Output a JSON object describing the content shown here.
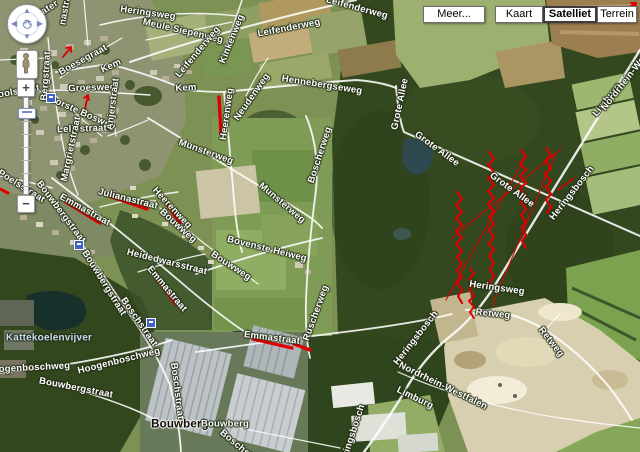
{
  "theme": {
    "red-overlay": "#dd0000",
    "stop-blue": "#3f63c8",
    "selected-border": "#3c3c3c",
    "label-halo": "#222d14"
  },
  "toolbar": {
    "buttons": [
      {
        "label": "Meer...",
        "selected": false
      },
      {
        "label": "Kaart",
        "selected": false
      },
      {
        "label": "Satelliet",
        "selected": true
      },
      {
        "label": "Terrein",
        "selected": false
      }
    ]
  },
  "nav": {
    "zoom_in_label": "+",
    "zoom_out_label": "−",
    "arrows": {
      "up": "▲",
      "down": "▼",
      "left": "◀",
      "right": "▶"
    }
  },
  "map": {
    "labels": [
      {
        "text": "Heringsweg",
        "x": 148,
        "y": 13,
        "rot": 8
      },
      {
        "text": "Meule Siepenweg",
        "x": 183,
        "y": 31,
        "rot": 13
      },
      {
        "text": "Leifenderweg",
        "x": 198,
        "y": 52,
        "rot": -50
      },
      {
        "text": "Kinkenweg",
        "x": 232,
        "y": 39,
        "rot": -68
      },
      {
        "text": "Leifenderweg",
        "x": 289,
        "y": 28,
        "rot": -11
      },
      {
        "text": "Leifenderweg",
        "x": 357,
        "y": 8,
        "rot": 15
      },
      {
        "text": "Hennebergseweg",
        "x": 322,
        "y": 85,
        "rot": 9
      },
      {
        "text": "Kem",
        "x": 111,
        "y": 66,
        "rot": -25
      },
      {
        "text": "Kem",
        "x": 186,
        "y": 88,
        "rot": -4
      },
      {
        "text": "Boesegraat",
        "x": 83,
        "y": 60,
        "rot": -29
      },
      {
        "text": "Groesweg",
        "x": 92,
        "y": 88,
        "rot": -2
      },
      {
        "text": "Voorste Bosweg",
        "x": 80,
        "y": 112,
        "rot": 24
      },
      {
        "text": "Anjerstraat",
        "x": 113,
        "y": 104,
        "rot": -83
      },
      {
        "text": "Leliestraat",
        "x": 82,
        "y": 129,
        "rot": -2
      },
      {
        "text": "Margrietstraat",
        "x": 71,
        "y": 149,
        "rot": -78
      },
      {
        "text": "Bergstraat",
        "x": 46,
        "y": 76,
        "rot": -86
      },
      {
        "text": "Schoolstraat",
        "x": 10,
        "y": 93,
        "rot": -10
      },
      {
        "text": "St Poelsstraat",
        "x": 16,
        "y": 183,
        "rot": 32
      },
      {
        "text": "Heerenweg",
        "x": 227,
        "y": 114,
        "rot": -82
      },
      {
        "text": "Neudenweg",
        "x": 252,
        "y": 97,
        "rot": -55
      },
      {
        "text": "Emmastraat",
        "x": 85,
        "y": 210,
        "rot": 29
      },
      {
        "text": "Julianastraat",
        "x": 128,
        "y": 199,
        "rot": 14
      },
      {
        "text": "Heerenweg",
        "x": 172,
        "y": 208,
        "rot": 47
      },
      {
        "text": "Bouwbergstraat",
        "x": 61,
        "y": 212,
        "rot": 53
      },
      {
        "text": "Bouwbergstraat",
        "x": 104,
        "y": 283,
        "rot": 58
      },
      {
        "text": "Heidedwarsstraat",
        "x": 167,
        "y": 262,
        "rot": 14
      },
      {
        "text": "Bouwweg",
        "x": 178,
        "y": 226,
        "rot": 42
      },
      {
        "text": "Bouwweg",
        "x": 231,
        "y": 266,
        "rot": 33
      },
      {
        "text": "Munsterweg",
        "x": 206,
        "y": 152,
        "rot": 20
      },
      {
        "text": "Munsterweg",
        "x": 282,
        "y": 203,
        "rot": 40
      },
      {
        "text": "Bovenste Heiweg",
        "x": 267,
        "y": 249,
        "rot": 14
      },
      {
        "text": "Boscherweg",
        "x": 320,
        "y": 155,
        "rot": -72
      },
      {
        "text": "Ruscherweg",
        "x": 316,
        "y": 313,
        "rot": -70
      },
      {
        "text": "Emmastraat",
        "x": 272,
        "y": 338,
        "rot": 7
      },
      {
        "text": "Emmastraat",
        "x": 167,
        "y": 289,
        "rot": 50
      },
      {
        "text": "Hoogenboschweg",
        "x": 28,
        "y": 368,
        "rot": -3
      },
      {
        "text": "Hoogenboschweg",
        "x": 119,
        "y": 361,
        "rot": -14
      },
      {
        "text": "Bouwbergstraat",
        "x": 76,
        "y": 388,
        "rot": 11
      },
      {
        "text": "Boschstraat",
        "x": 139,
        "y": 322,
        "rot": 55
      },
      {
        "text": "Boschstraat",
        "x": 177,
        "y": 391,
        "rot": 83
      },
      {
        "text": "Boschstraat",
        "x": 243,
        "y": 450,
        "rot": 40
      },
      {
        "text": "Kattekoelenvijver",
        "x": 49,
        "y": 338,
        "rot": 0,
        "type": "water"
      },
      {
        "text": "Bouwberg",
        "x": 180,
        "y": 425,
        "rot": 0,
        "type": "place"
      },
      {
        "text": "Bouwberg",
        "x": 225,
        "y": 424,
        "rot": 0
      },
      {
        "text": "Retweg",
        "x": 493,
        "y": 314,
        "rot": 6
      },
      {
        "text": "Retweg",
        "x": 551,
        "y": 342,
        "rot": 52
      },
      {
        "text": "Heringsbosch",
        "x": 572,
        "y": 193,
        "rot": -52
      },
      {
        "text": "Heringsbosch",
        "x": 416,
        "y": 338,
        "rot": -52
      },
      {
        "text": "Heringsbosch",
        "x": 352,
        "y": 436,
        "rot": -72
      },
      {
        "text": "Heringsweg",
        "x": 497,
        "y": 288,
        "rot": 8
      },
      {
        "text": "Limburg",
        "x": 607,
        "y": 100,
        "rot": -52
      },
      {
        "text": "Nordrhein-Westf",
        "x": 627,
        "y": 79,
        "rot": -52
      },
      {
        "text": "Nordrhein-Westfalen",
        "x": 443,
        "y": 386,
        "rot": 26
      },
      {
        "text": "Limburg",
        "x": 415,
        "y": 398,
        "rot": 26
      },
      {
        "text": "Grote Allee",
        "x": 437,
        "y": 149,
        "rot": 36
      },
      {
        "text": "Grote Allee",
        "x": 512,
        "y": 190,
        "rot": 36
      },
      {
        "text": "Grote Allee",
        "x": 400,
        "y": 104,
        "rot": -78
      },
      {
        "text": "Water",
        "x": 46,
        "y": 10,
        "rot": -33
      },
      {
        "text": "nastraat",
        "x": 66,
        "y": 6,
        "rot": -80
      }
    ],
    "transit_stops": [
      {
        "x": 50,
        "y": 97
      },
      {
        "x": 78,
        "y": 244
      },
      {
        "x": 150,
        "y": 322
      }
    ]
  }
}
